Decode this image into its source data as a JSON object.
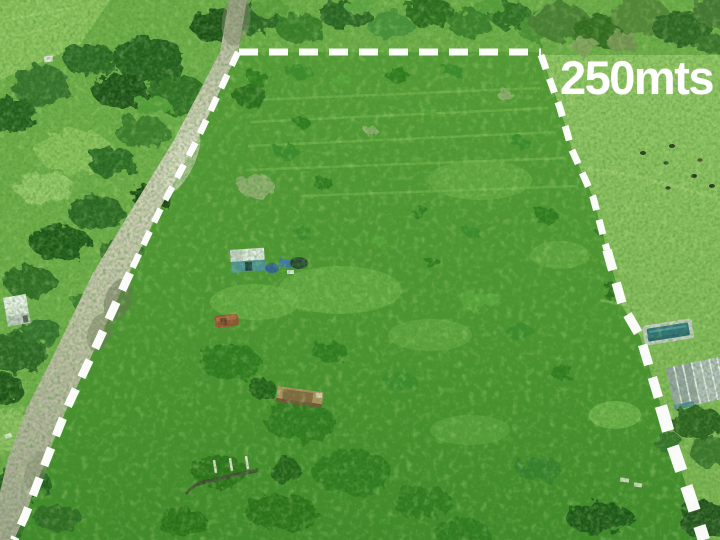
{
  "annotation": {
    "distance_label": "250mts",
    "label_color": "#ffffff",
    "boundary_color": "#ffffff",
    "boundary_style": "dashed"
  },
  "scene": {
    "kind": "aerial-drone-photo",
    "subject": "rural grass land plot outlined with white dashed boundary, dirt road on the left, neighboring mowed field with cattle, pool and house on the right",
    "objects": [
      "tree-line",
      "rural-road",
      "marked-plot",
      "neighbor-field",
      "cattle",
      "swimming-pool",
      "neighbor-house",
      "roadside-shed",
      "plot-cabin",
      "parked-car",
      "rusty-trailer",
      "log-fence"
    ],
    "palette": {
      "plot_green": "#4f9631",
      "meadow_green": "#86bd57",
      "tree_green": "#275e1f",
      "road_tan": "#cfcab6",
      "pool_water": "#2f6e7e",
      "roof_gray": "#b7bec2"
    }
  }
}
